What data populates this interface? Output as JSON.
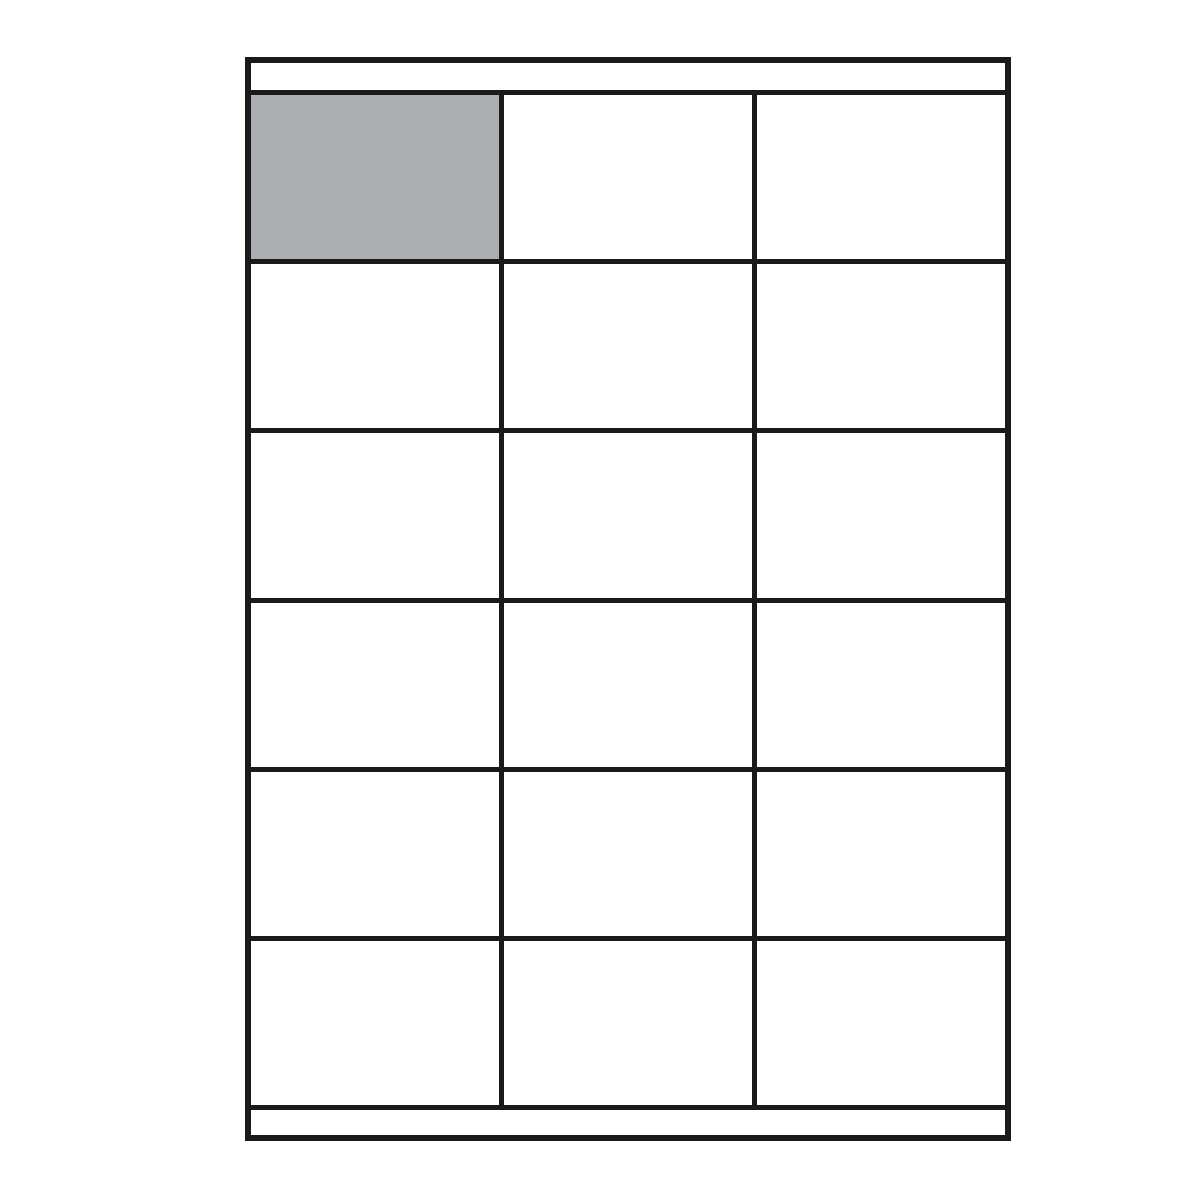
{
  "diagram": {
    "description": "Label sheet layout diagram: A4-style sheet showing adhesive label positions",
    "sheet": {
      "orientation": "portrait",
      "top_margin_strip": true,
      "bottom_margin_strip": true,
      "grid": {
        "rows": 6,
        "columns": 3,
        "label_count": 18,
        "highlighted_cell": {
          "row": 1,
          "column": 1
        }
      }
    },
    "colors": {
      "line": "#1a1a1a",
      "sheet_background": "#ffffff",
      "page_background": "#ffffff",
      "highlight_fill": "#abaeb2"
    }
  }
}
